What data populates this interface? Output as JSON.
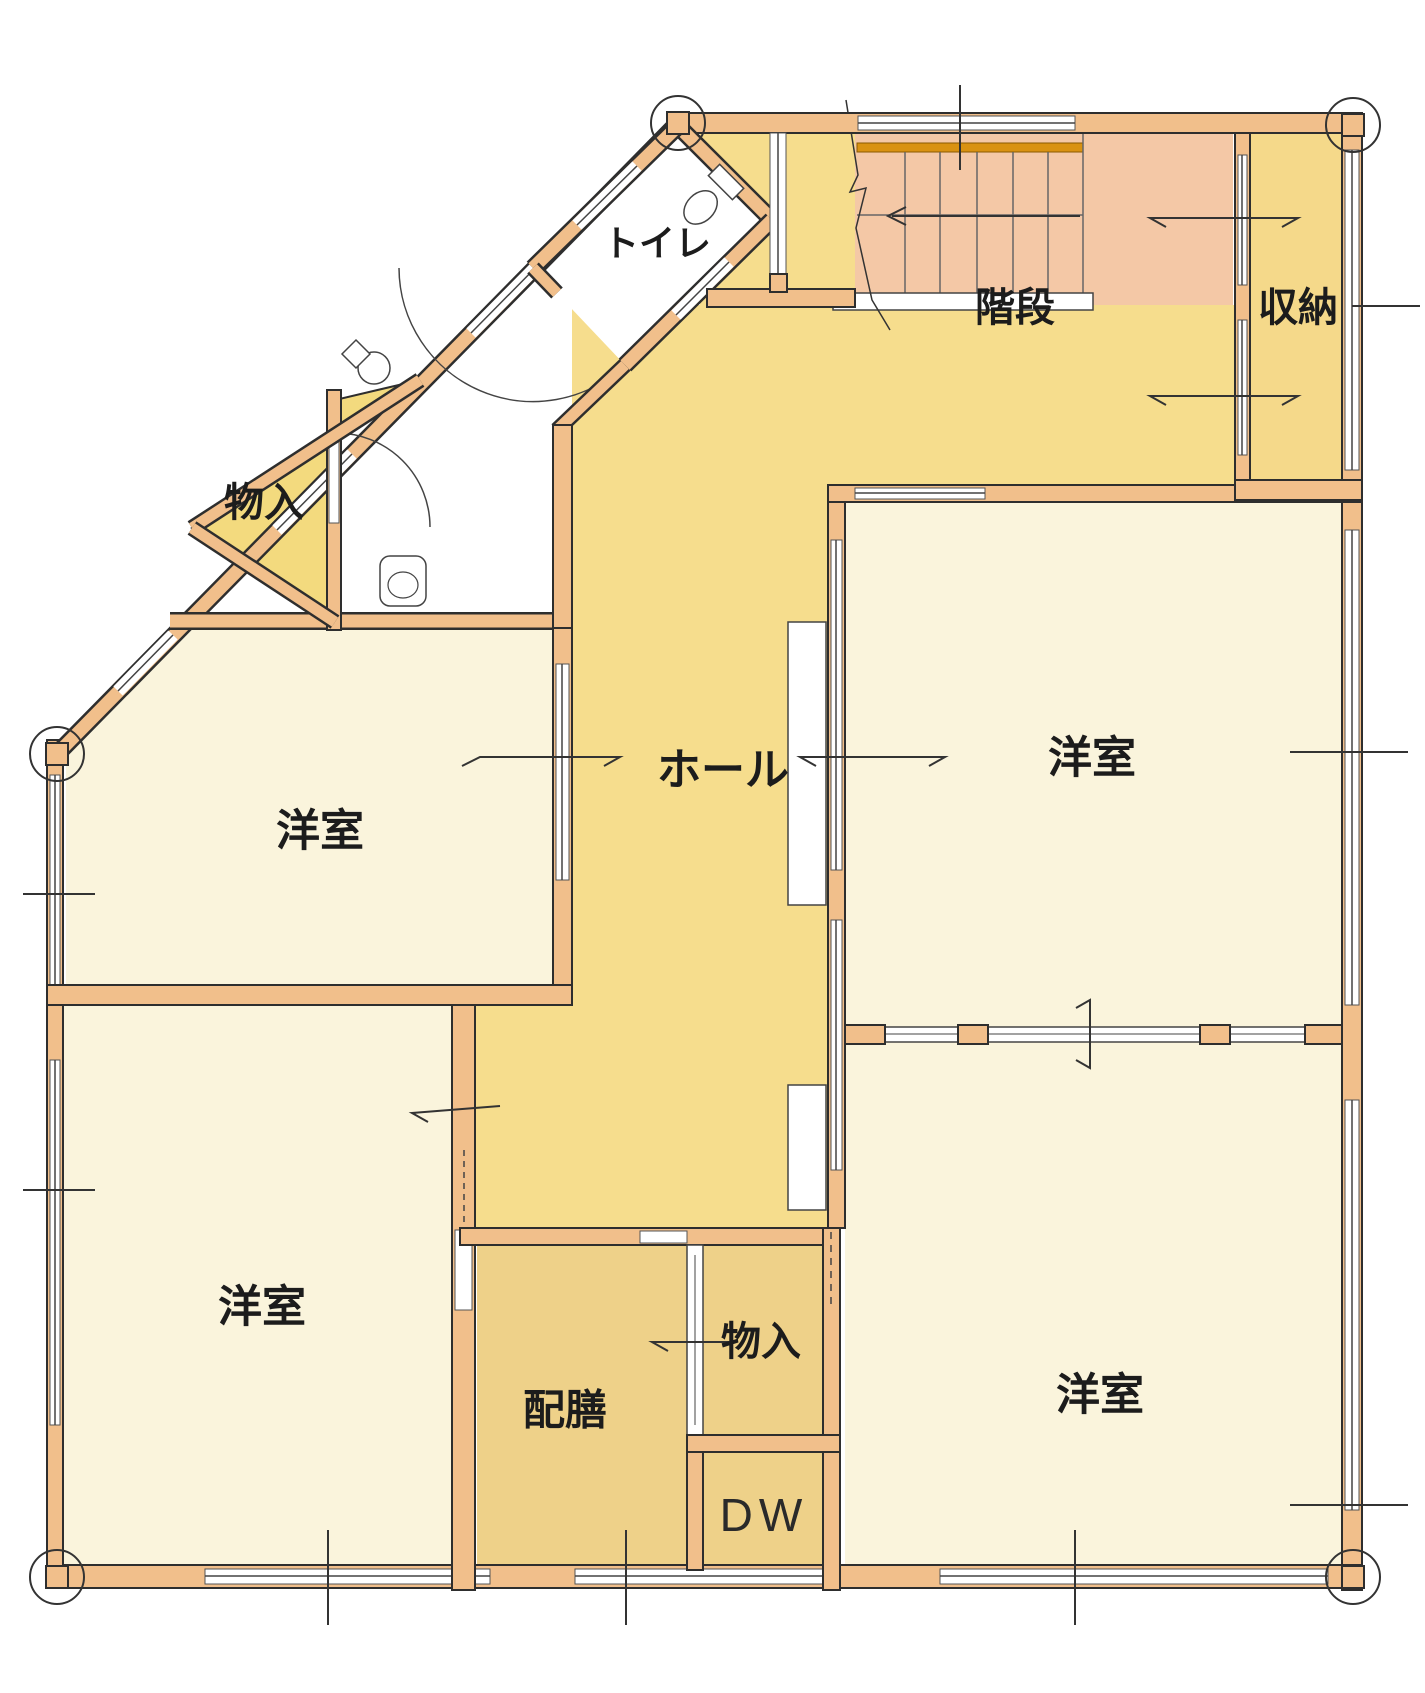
{
  "plan": {
    "kind": "japanese-residential-floor-plan",
    "visible_fixtures": [
      "toilet-bowl",
      "wash-basin",
      "second-toilet-fixture",
      "staircase-treads"
    ],
    "stair_direction_arrow": "left-with-break-line"
  },
  "rooms": [
    {
      "id": "toilet",
      "label": "トイレ"
    },
    {
      "id": "stairs",
      "label": "階段"
    },
    {
      "id": "storage",
      "label": "収納"
    },
    {
      "id": "closet-upper-left",
      "label": "物入"
    },
    {
      "id": "hall",
      "label": "ホール"
    },
    {
      "id": "western-room-middle-left",
      "label": "洋室"
    },
    {
      "id": "western-room-upper-right",
      "label": "洋室"
    },
    {
      "id": "western-room-lower-left",
      "label": "洋室"
    },
    {
      "id": "western-room-lower-right",
      "label": "洋室"
    },
    {
      "id": "pantry",
      "label": "配膳"
    },
    {
      "id": "closet-bottom-center",
      "label": "物入"
    },
    {
      "id": "dumbwaiter",
      "label": "DW"
    }
  ],
  "colors": {
    "background": "#ffffff",
    "wall_fill": "#f1bf8b",
    "wall_outline": "#2e2e2e",
    "room_cream": "#faf4dc",
    "hall_yellow": "#f6dd8d",
    "closet_tan": "#eed189",
    "storage_yellow": "#f5d98a",
    "stair_pink": "#f4c8a6",
    "stair_accent_bar": "#d99212",
    "thin_line": "#444444"
  }
}
